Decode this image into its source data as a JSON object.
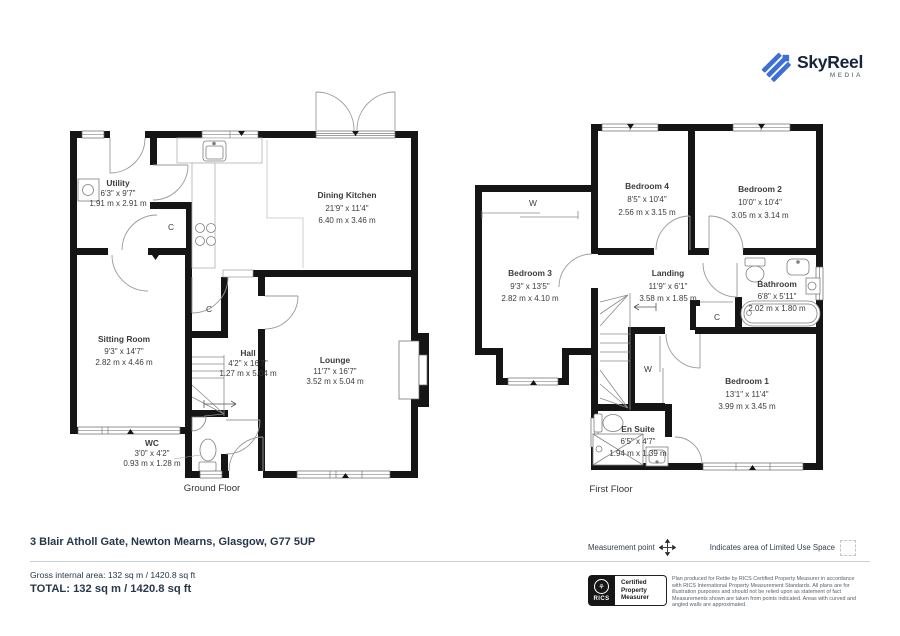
{
  "logo": {
    "name": "SkyReel",
    "sub": "MEDIA"
  },
  "ground_floor": {
    "caption": "Ground Floor",
    "closet1": "C",
    "closet2": "C",
    "rooms": {
      "utility": {
        "name": "Utility",
        "imperial": "6'3\" x 9'7\"",
        "metric": "1.91 m x 2.91 m"
      },
      "dining_kitchen": {
        "name": "Dining Kitchen",
        "imperial": "21'9\" x 11'4\"",
        "metric": "6.40 m x 3.46 m"
      },
      "sitting_room": {
        "name": "Sitting Room",
        "imperial": "9'3\" x 14'7\"",
        "metric": "2.82 m x 4.46 m"
      },
      "hall": {
        "name": "Hall",
        "imperial": "4'2\" x 16'7\"",
        "metric": "1.27 m x 5.04 m"
      },
      "lounge": {
        "name": "Lounge",
        "imperial": "11'7\" x 16'7\"",
        "metric": "3.52 m x 5.04 m"
      },
      "wc": {
        "name": "WC",
        "imperial": "3'0\" x 4'2\"",
        "metric": "0.93 m x 1.28 m"
      }
    }
  },
  "first_floor": {
    "caption": "First Floor",
    "wardrobe_top": "W",
    "wardrobe_bed1": "W",
    "closet": "C",
    "rooms": {
      "bedroom1": {
        "name": "Bedroom 1",
        "imperial": "13'1\" x 11'4\"",
        "metric": "3.99 m x 3.45 m"
      },
      "bedroom2": {
        "name": "Bedroom 2",
        "imperial": "10'0\" x 10'4\"",
        "metric": "3.05 m x 3.14 m"
      },
      "bedroom3": {
        "name": "Bedroom 3",
        "imperial": "9'3\" x 13'5\"",
        "metric": "2.82 m x 4.10 m"
      },
      "bedroom4": {
        "name": "Bedroom 4",
        "imperial": "8'5\" x 10'4\"",
        "metric": "2.56 m x 3.15 m"
      },
      "landing": {
        "name": "Landing",
        "imperial": "11'9\" x 6'1\"",
        "metric": "3.58 m x 1.85 m"
      },
      "bathroom": {
        "name": "Bathroom",
        "imperial": "6'8\" x 5'11\"",
        "metric": "2.02 m x 1.80 m"
      },
      "en_suite": {
        "name": "En Suite",
        "imperial": "6'5\" x 4'7\"",
        "metric": "1.94 m x 1.39 m"
      }
    }
  },
  "footer": {
    "address": "3 Blair Atholl Gate, Newton Mearns, Glasgow, G77 5UP",
    "gross": "Gross internal area: 132 sq m / 1420.8 sq ft",
    "total": "TOTAL: 132 sq m / 1420.8 sq ft",
    "legend": {
      "measurement_point": "Measurement point",
      "limited_use": "Indicates area of  Limited Use Space"
    },
    "rics": {
      "brand": "RICS",
      "line1": "Certified",
      "line2": "Property",
      "line3": "Measurer"
    },
    "disclaimer": "Plan produced for Rettie by RICS Certified Property Measurer in accordance with RICS International Property Measurement Standards. All plans are for illustration purposes and should not be relied upon as statement of fact Measurements shown are taken from points indicated. Areas with curved and angled walls are approximated."
  },
  "colors": {
    "wall": "#151515",
    "accent_blue": "#3e6fd4",
    "text_dark": "#26374a"
  }
}
